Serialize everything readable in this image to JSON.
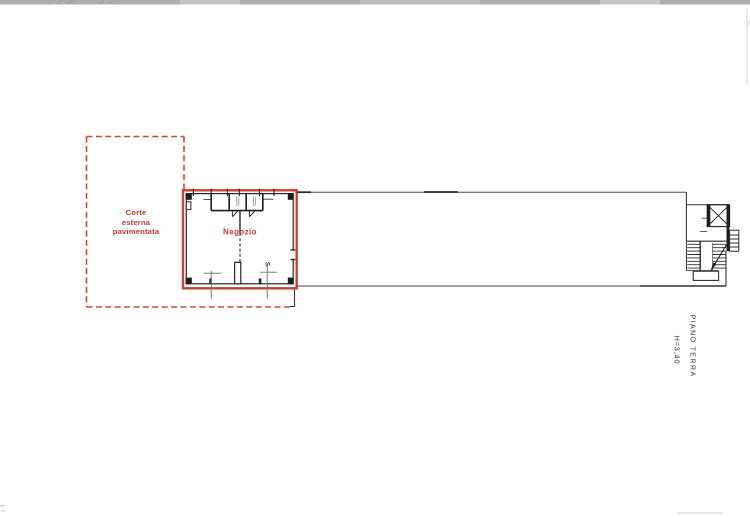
{
  "plan": {
    "courtyard_label_lines": [
      "Corte",
      "esterna",
      "pavimentata"
    ],
    "shop_label": "Negozio",
    "stair_mark": "S",
    "side_note": {
      "line1": "PIANO TERRA",
      "line2": "H=3,40"
    },
    "colors": {
      "red_outline": "#c9422e",
      "red_dashed": "#cf4a36",
      "red_text": "#c53a2c",
      "wall_dark": "#1e1e1e",
      "wall_line": "#3f3f3f",
      "dimension_line": "#7d7d7d",
      "scan_band": "#b0b0b0"
    }
  }
}
